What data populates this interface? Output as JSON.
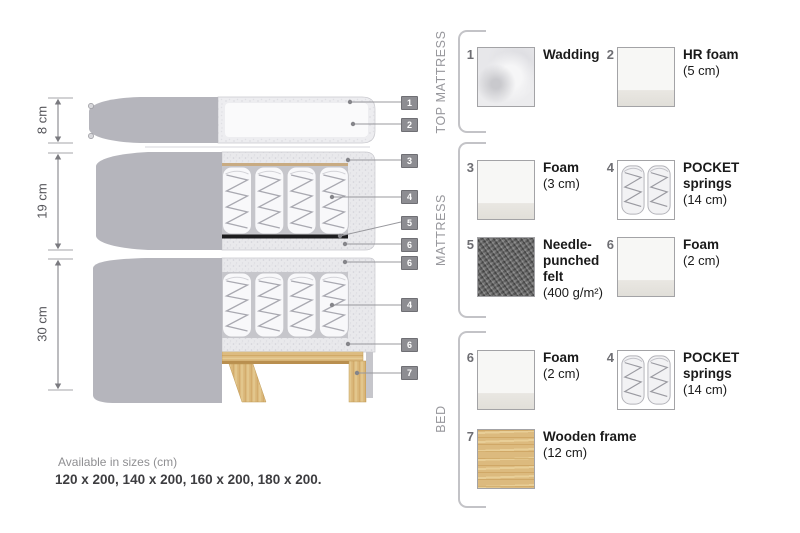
{
  "diagram": {
    "dimensions": [
      {
        "label": "8 cm"
      },
      {
        "label": "19 cm"
      },
      {
        "label": "30 cm"
      }
    ],
    "callouts": {
      "c1": "1",
      "c2": "2",
      "c3": "3",
      "c4a": "4",
      "c5": "5",
      "c6a": "6",
      "c6b": "6",
      "c4b": "4",
      "c6c": "6",
      "c7": "7"
    }
  },
  "legend": {
    "sections": [
      {
        "title": "TOP MATTRESS",
        "items": [
          {
            "num": "1",
            "name": "Wadding",
            "detail": "",
            "swatch": "wadding"
          },
          {
            "num": "2",
            "name": "HR foam",
            "detail": "(5 cm)",
            "swatch": "foam"
          }
        ]
      },
      {
        "title": "MATTRESS",
        "items": [
          {
            "num": "3",
            "name": "Foam",
            "detail": "(3 cm)",
            "swatch": "foam"
          },
          {
            "num": "4",
            "name": "POCKET\nsprings",
            "detail": "(14 cm)",
            "swatch": "pocket-springs"
          },
          {
            "num": "5",
            "name": "Needle-\npunched\nfelt",
            "detail": "(400 g/m²)",
            "swatch": "felt"
          },
          {
            "num": "6",
            "name": "Foam",
            "detail": "(2 cm)",
            "swatch": "foam"
          }
        ]
      },
      {
        "title": "BED",
        "items": [
          {
            "num": "6",
            "name": "Foam",
            "detail": "(2 cm)",
            "swatch": "foam"
          },
          {
            "num": "4",
            "name": "POCKET\nsprings",
            "detail": "(14 cm)",
            "swatch": "pocket-springs"
          },
          {
            "num": "7",
            "name": "Wooden frame",
            "detail": "(12 cm)",
            "swatch": "wood"
          }
        ]
      }
    ]
  },
  "footer": {
    "title": "Available in sizes (cm)",
    "sizes": "120 x 200, 140 x 200, 160 x 200, 180 x 200."
  },
  "colors": {
    "cover_grey": "#b5b5bc",
    "foam_light": "#e9e9ec",
    "wood": "#dcba7e",
    "felt_dark": "#1c1c1e",
    "chip_grey": "#8d8d92"
  }
}
